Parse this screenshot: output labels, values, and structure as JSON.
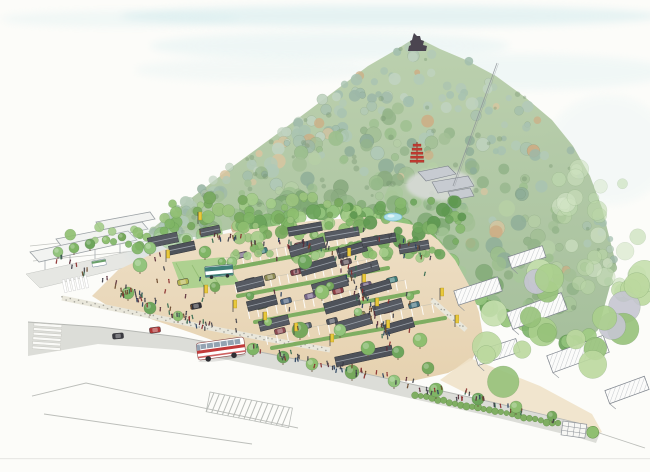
{
  "palette": {
    "paper": "#fcfcf9",
    "sky_wash": "#cfe9ec",
    "sky_wash_light": "#dfeff1",
    "mountain_top": "#b7cda8",
    "mountain_bottom": "#9eba94",
    "plaza_sand": "#ead9bd",
    "sidewalk_sand": "#efe2c9",
    "road_gray": "#dcddd8",
    "roof_dark": "#565a62",
    "roof_dark2": "#4e525a",
    "roof_ridge": "#9aa0a8",
    "roof_gray_light": "#c7cbd1",
    "pencil": "#9aa0a6",
    "hedge_green": "#7fae62",
    "hedge_dark": "#5e8c43",
    "lawn_green": "#aed190",
    "banner_yellow": "#e9c93a",
    "banner_edge": "#b89a20",
    "bus_red": "#c23b3b",
    "shuttle_teal": "#3f7f78",
    "pond_blue": "#aee0ea",
    "pond_edge": "#7ab8cc",
    "pagoda_red": "#c13b30",
    "castle_dark": "#4b4550",
    "trunk": "#6b563e",
    "stone_dot": "#a5a49c",
    "wall_fill": "#e9e7db"
  },
  "sky": {
    "washes": [
      [
        390,
        16,
        270,
        11,
        "#cfe9ec",
        0.5
      ],
      [
        120,
        19,
        120,
        8,
        "#cfe9ec",
        0.25
      ],
      [
        330,
        46,
        180,
        14,
        "#d9eef0",
        0.38
      ],
      [
        520,
        72,
        150,
        18,
        "#d9eef0",
        0.32
      ],
      [
        608,
        150,
        62,
        55,
        "#e4f2f3",
        0.3
      ],
      [
        255,
        70,
        120,
        12,
        "#e0f0f1",
        0.3
      ]
    ]
  },
  "mist": [
    [
      205,
      253,
      78,
      16,
      "#cfdde2",
      0.32
    ],
    [
      158,
      237,
      42,
      10,
      "#dde8ea",
      0.3
    ]
  ],
  "mountain": {
    "ridge": [
      [
        148,
        232
      ],
      [
        168,
        216
      ],
      [
        198,
        193
      ],
      [
        232,
        167
      ],
      [
        266,
        142
      ],
      [
        300,
        117
      ],
      [
        336,
        90
      ],
      [
        368,
        66
      ],
      [
        394,
        51
      ],
      [
        410,
        41
      ],
      [
        422,
        40
      ],
      [
        440,
        49
      ],
      [
        466,
        60
      ],
      [
        496,
        76
      ],
      [
        526,
        98
      ],
      [
        552,
        120
      ],
      [
        573,
        146
      ],
      [
        590,
        176
      ],
      [
        602,
        208
      ],
      [
        610,
        240
      ],
      [
        616,
        264
      ]
    ],
    "base": [
      [
        148,
        232
      ],
      [
        172,
        240
      ],
      [
        200,
        236
      ],
      [
        235,
        228
      ],
      [
        270,
        220
      ],
      [
        305,
        215
      ],
      [
        340,
        212
      ],
      [
        372,
        215
      ],
      [
        398,
        221
      ],
      [
        418,
        233
      ],
      [
        438,
        250
      ],
      [
        455,
        267
      ],
      [
        470,
        288
      ],
      [
        486,
        307
      ],
      [
        502,
        318
      ],
      [
        520,
        325
      ],
      [
        540,
        333
      ],
      [
        560,
        340
      ],
      [
        580,
        347
      ],
      [
        598,
        330
      ],
      [
        616,
        264
      ]
    ],
    "blob_count": 390,
    "accent_count": 60,
    "pal_top": [
      "#a9c3b1",
      "#b3cab7",
      "#9db8a8",
      "#c0d3c0",
      "#a3bfae"
    ],
    "pal_mid": [
      "#a3c096",
      "#94b48a",
      "#b6cfa6",
      "#9cbf8e",
      "#b0c9b8",
      "#8fae98"
    ],
    "pal_low": [
      "#8aab80",
      "#7fa974",
      "#9cbf8e",
      "#a8c79a",
      "#93b889"
    ],
    "pal_tan": [
      "#d8c5a0",
      "#cdae85"
    ],
    "fringe": {
      "n": 64,
      "pal": [
        "#7fb56b",
        "#93c47d",
        "#6da55c",
        "#a1cc85"
      ]
    }
  },
  "belt_pals": {
    "mid": [
      "#8fbf70",
      "#7fb565",
      "#9cc47e",
      "#76a85c",
      "#a5cd8a"
    ],
    "dark": [
      "#6da55c",
      "#5e9850",
      "#79ad62",
      "#86b96d"
    ],
    "big": [
      "#abd08d",
      "#bcd99f",
      "#97c27a",
      "#c6e0ae",
      "#c6c6d2"
    ],
    "fade": [
      "#cfe3c0",
      "#bcd8a8",
      "#d8e8cc",
      "#c2ddb2"
    ]
  },
  "belts": [
    {
      "x": 160,
      "y": 196,
      "w": 200,
      "h": 44,
      "n": 70,
      "pal": "mid",
      "rmin": 3,
      "rmax": 7
    },
    {
      "x": 340,
      "y": 200,
      "w": 130,
      "h": 58,
      "n": 55,
      "pal": "dark",
      "rmin": 3,
      "rmax": 7
    },
    {
      "x": 40,
      "y": 225,
      "w": 110,
      "h": 24,
      "n": 12,
      "pal": "mid",
      "rmin": 3,
      "rmax": 6
    },
    {
      "x": 215,
      "y": 244,
      "w": 210,
      "h": 16,
      "n": 22,
      "pal": "mid",
      "rmin": 3,
      "rmax": 5
    },
    {
      "x": 455,
      "y": 265,
      "w": 190,
      "h": 135,
      "n": 26,
      "pal": "big",
      "rmin": 8,
      "rmax": 16
    },
    {
      "x": 555,
      "y": 165,
      "w": 90,
      "h": 135,
      "n": 30,
      "pal": "fade",
      "rmin": 5,
      "rmax": 10
    }
  ],
  "structures": {
    "castle": [
      [
        414,
        33
      ],
      [
        417,
        36
      ],
      [
        420,
        36
      ],
      [
        421,
        40
      ],
      [
        424,
        41
      ],
      [
        423,
        45
      ],
      [
        427,
        46
      ],
      [
        426,
        51
      ],
      [
        408,
        51
      ],
      [
        409,
        46
      ],
      [
        411,
        45
      ],
      [
        410,
        41
      ],
      [
        412,
        40
      ],
      [
        413,
        36
      ]
    ],
    "ropeway": {
      "x1": 497,
      "y1": 63,
      "x2": 453,
      "y2": 186
    },
    "clearing": [
      440,
      185,
      34,
      16,
      "#d9dbd9",
      0.85
    ],
    "temple_roofs": [
      [
        [
          418,
          172
        ],
        [
          448,
          166
        ],
        [
          456,
          174
        ],
        [
          426,
          181
        ]
      ],
      [
        [
          432,
          182
        ],
        [
          468,
          176
        ],
        [
          474,
          186
        ],
        [
          438,
          193
        ]
      ],
      [
        [
          448,
          192
        ],
        [
          470,
          188
        ],
        [
          474,
          196
        ],
        [
          452,
          200
        ]
      ]
    ],
    "pagoda": {
      "x": 417,
      "ytop": 142,
      "ybot": 164,
      "tiers": [
        [
          144,
          8
        ],
        [
          148,
          10
        ],
        [
          152,
          12
        ],
        [
          156,
          13
        ],
        [
          160,
          14
        ]
      ]
    },
    "pond": {
      "x": 393,
      "y": 217,
      "rx": 9,
      "ry": 4
    }
  },
  "ground": {
    "plaza": [
      [
        92,
        296
      ],
      [
        118,
        270
      ],
      [
        152,
        254
      ],
      [
        192,
        240
      ],
      [
        245,
        230
      ],
      [
        310,
        221
      ],
      [
        368,
        217
      ],
      [
        420,
        226
      ],
      [
        438,
        240
      ],
      [
        455,
        260
      ],
      [
        470,
        287
      ],
      [
        479,
        312
      ],
      [
        483,
        336
      ],
      [
        472,
        360
      ],
      [
        448,
        373
      ],
      [
        412,
        381
      ],
      [
        372,
        379
      ],
      [
        330,
        372
      ],
      [
        286,
        362
      ],
      [
        240,
        350
      ],
      [
        192,
        333
      ],
      [
        142,
        316
      ],
      [
        108,
        306
      ]
    ],
    "sidewalk": [
      [
        470,
        358
      ],
      [
        540,
        386
      ],
      [
        592,
        414
      ],
      [
        602,
        432
      ],
      [
        590,
        438
      ],
      [
        538,
        418
      ],
      [
        468,
        394
      ],
      [
        440,
        380
      ]
    ],
    "road": [
      [
        28,
        322
      ],
      [
        100,
        327
      ],
      [
        180,
        337
      ],
      [
        260,
        352
      ],
      [
        340,
        368
      ],
      [
        420,
        386
      ],
      [
        500,
        404
      ],
      [
        578,
        423
      ],
      [
        600,
        433
      ],
      [
        596,
        443
      ],
      [
        576,
        437
      ],
      [
        498,
        418
      ],
      [
        418,
        400
      ],
      [
        338,
        382
      ],
      [
        258,
        366
      ],
      [
        178,
        350
      ],
      [
        98,
        344
      ],
      [
        28,
        356
      ]
    ],
    "street": [
      [
        26,
        274
      ],
      [
        182,
        240
      ],
      [
        194,
        251
      ],
      [
        40,
        288
      ]
    ],
    "lawn": [
      [
        172,
        262
      ],
      [
        224,
        257
      ],
      [
        240,
        284
      ],
      [
        182,
        289
      ]
    ],
    "pencil_lines": [
      [
        [
          32,
          396
        ],
        [
          86,
          383
        ],
        [
          298,
          428
        ]
      ],
      [
        [
          44,
          414
        ],
        [
          252,
          444
        ]
      ],
      [
        [
          575,
          425
        ],
        [
          645,
          448
        ]
      ]
    ],
    "stone_walls": [
      [
        [
          62,
          298
        ],
        [
          120,
          310
        ],
        [
          170,
          320
        ],
        [
          220,
          330
        ],
        [
          272,
          340
        ],
        [
          330,
          350
        ]
      ],
      [
        [
          432,
          300
        ],
        [
          466,
          330
        ]
      ]
    ],
    "zebra1": {
      "x": 62,
      "y": 280,
      "rot": -12,
      "n": 6
    },
    "zebra2": {
      "x": 34,
      "y": 323,
      "rot": 4,
      "n": 6
    },
    "hatch_walk": {
      "x": 210,
      "y": 392,
      "rot": 11,
      "w": 84,
      "h": 20
    }
  },
  "parking": {
    "stall_rows": [
      [
        225,
        258,
        345,
        236,
        14
      ],
      [
        235,
        284,
        375,
        258,
        16
      ],
      [
        248,
        310,
        405,
        280,
        17
      ],
      [
        266,
        336,
        432,
        304,
        16
      ]
    ],
    "hedges": [
      [
        222,
        270,
        348,
        246
      ],
      [
        238,
        296,
        388,
        268
      ],
      [
        255,
        322,
        418,
        292
      ],
      [
        272,
        348,
        445,
        318
      ]
    ],
    "car_colors": [
      "#6b5a7a",
      "#3f7d78",
      "#8a4a50",
      "#55606b",
      "#4a4f59",
      "#8c8a52",
      "#7a3d46",
      "#44707d",
      "#53474f",
      "#6e8a5a",
      "#4a5f7a",
      "#776688",
      "#8a3b42"
    ],
    "cars": [
      [
        242,
        255
      ],
      [
        262,
        251
      ],
      [
        300,
        245
      ],
      [
        318,
        242
      ],
      [
        250,
        281
      ],
      [
        270,
        277
      ],
      [
        296,
        272
      ],
      [
        322,
        267
      ],
      [
        346,
        262
      ],
      [
        262,
        306
      ],
      [
        286,
        301
      ],
      [
        310,
        296
      ],
      [
        338,
        291
      ],
      [
        366,
        285
      ],
      [
        392,
        280
      ],
      [
        280,
        331
      ],
      [
        306,
        326
      ],
      [
        332,
        321
      ],
      [
        360,
        315
      ],
      [
        388,
        310
      ],
      [
        414,
        305
      ]
    ],
    "car_rot": -14
  },
  "shop_roofs": [
    [
      307,
      247,
      36,
      11,
      -16
    ],
    [
      318,
      266,
      36,
      11,
      -16
    ],
    [
      330,
      285,
      36,
      11,
      -16
    ],
    [
      342,
      304,
      36,
      11,
      -16
    ],
    [
      354,
      323,
      36,
      11,
      -16
    ],
    [
      352,
      250,
      30,
      10,
      -16
    ],
    [
      364,
      269,
      30,
      10,
      -16
    ],
    [
      376,
      288,
      30,
      10,
      -16
    ],
    [
      388,
      307,
      30,
      10,
      -16
    ],
    [
      399,
      326,
      30,
      10,
      -16
    ],
    [
      250,
      284,
      28,
      10,
      -14
    ],
    [
      262,
      303,
      30,
      10,
      -14
    ],
    [
      274,
      323,
      30,
      10,
      -14
    ],
    [
      305,
      229,
      34,
      9,
      -10
    ],
    [
      342,
      234,
      34,
      9,
      -10
    ],
    [
      379,
      240,
      34,
      9,
      -10
    ],
    [
      414,
      247,
      30,
      9,
      -10
    ],
    [
      364,
      356,
      58,
      10,
      -12
    ],
    [
      163,
      240,
      30,
      10,
      -12
    ],
    [
      182,
      248,
      26,
      9,
      -12
    ],
    [
      210,
      231,
      20,
      8,
      -12
    ]
  ],
  "sketch_roofs": [
    [
      478,
      291,
      46,
      15,
      -18
    ],
    [
      537,
      311,
      58,
      18,
      -20
    ],
    [
      578,
      354,
      60,
      18,
      -20
    ],
    [
      497,
      352,
      44,
      14,
      -18
    ],
    [
      627,
      390,
      42,
      14,
      -20
    ],
    [
      527,
      257,
      36,
      12,
      -18
    ]
  ],
  "grid_piece": {
    "x": 563,
    "y": 421,
    "rot": 8,
    "w": 24,
    "h": 14,
    "bush_r": 6
  },
  "hedge_row": {
    "x0": 415,
    "y0": 395,
    "x1": 558,
    "y1": 424,
    "n": 26
  },
  "trees": {
    "colors": [
      "#7fb565",
      "#6da55c",
      "#8fbf70",
      "#76a85c",
      "#93c47d"
    ],
    "list": [
      [
        253,
        349,
        6
      ],
      [
        283,
        357,
        6
      ],
      [
        312,
        364,
        6
      ],
      [
        352,
        372,
        7
      ],
      [
        394,
        381,
        6
      ],
      [
        436,
        390,
        7
      ],
      [
        478,
        399,
        6
      ],
      [
        516,
        407,
        6
      ],
      [
        552,
        416,
        5
      ],
      [
        58,
        252,
        5
      ],
      [
        74,
        248,
        5
      ],
      [
        90,
        244,
        5
      ],
      [
        106,
        240,
        4
      ],
      [
        122,
        237,
        4
      ],
      [
        140,
        265,
        7
      ],
      [
        128,
        293,
        6
      ],
      [
        150,
        308,
        6
      ],
      [
        178,
        316,
        5
      ],
      [
        215,
        287,
        5
      ],
      [
        232,
        262,
        5
      ],
      [
        222,
        262,
        4
      ],
      [
        250,
        296,
        4
      ],
      [
        268,
        322,
        4
      ],
      [
        330,
        286,
        4
      ],
      [
        358,
        312,
        4
      ],
      [
        410,
        296,
        4
      ],
      [
        305,
        262,
        7
      ],
      [
        322,
        292,
        7
      ],
      [
        300,
        330,
        8
      ],
      [
        340,
        330,
        6
      ],
      [
        368,
        348,
        7
      ],
      [
        398,
        352,
        6
      ],
      [
        420,
        340,
        7
      ],
      [
        428,
        368,
        6
      ],
      [
        150,
        248,
        6
      ],
      [
        205,
        252,
        6
      ]
    ]
  },
  "banners": [
    [
      198,
      224
    ],
    [
      166,
      262
    ],
    [
      204,
      297
    ],
    [
      233,
      312
    ],
    [
      263,
      324
    ],
    [
      294,
      335
    ],
    [
      330,
      346
    ],
    [
      347,
      260
    ],
    [
      362,
      286
    ],
    [
      375,
      310
    ],
    [
      386,
      332
    ],
    [
      440,
      300
    ],
    [
      455,
      327
    ]
  ],
  "vehicles": {
    "tour_bus": {
      "x": 221,
      "y": 349,
      "rot": -8
    },
    "shuttle": {
      "x": 219,
      "y": 271,
      "rot": -5
    },
    "minibus": {
      "x": 99,
      "y": 263,
      "rot": -10
    },
    "cars": [
      [
        118,
        336,
        -5,
        "#3a3a40"
      ],
      [
        155,
        330,
        -7,
        "#b03636"
      ],
      [
        196,
        306,
        -11,
        "#2f2f35"
      ],
      [
        183,
        282,
        -12,
        "#b5b551"
      ]
    ]
  },
  "people": {
    "colors": [
      "#3a3a44",
      "#5a2e3a",
      "#27405e",
      "#8a2e2e",
      "#356a4f",
      "#6b4a2e",
      "#44444c"
    ],
    "bands": [
      [
        120,
        290,
        212,
        330,
        10,
        40
      ],
      [
        198,
        236,
        330,
        248,
        8,
        35
      ],
      [
        334,
        252,
        392,
        348,
        11,
        45
      ],
      [
        252,
        348,
        468,
        398,
        9,
        50
      ],
      [
        56,
        258,
        140,
        298,
        8,
        20
      ],
      [
        460,
        392,
        558,
        424,
        6,
        15
      ],
      [
        352,
        228,
        420,
        248,
        8,
        12
      ]
    ],
    "boxes": [
      [
        232,
        252,
        200,
        80,
        25
      ],
      [
        150,
        255,
        70,
        60,
        12
      ]
    ]
  },
  "station": {
    "canopies": [
      [
        [
          96,
          222
        ],
        [
          150,
          212
        ],
        [
          155,
          219
        ],
        [
          101,
          230
        ]
      ],
      [
        [
          56,
          239
        ],
        [
          142,
          222
        ],
        [
          148,
          229
        ],
        [
          62,
          247
        ]
      ],
      [
        [
          30,
          252
        ],
        [
          128,
          231
        ],
        [
          137,
          240
        ],
        [
          39,
          262
        ]
      ]
    ],
    "tracks": [
      [
        [
          30,
          246
        ],
        [
          205,
          228
        ]
      ],
      [
        [
          30,
          253
        ],
        [
          210,
          235
        ]
      ],
      [
        [
          33,
          261
        ],
        [
          215,
          243
        ]
      ]
    ],
    "building": {
      "x": 190,
      "y": 218,
      "rot": -10,
      "w": 28,
      "h": 18
    }
  },
  "artifacts": {
    "scan_line_y": 458
  }
}
